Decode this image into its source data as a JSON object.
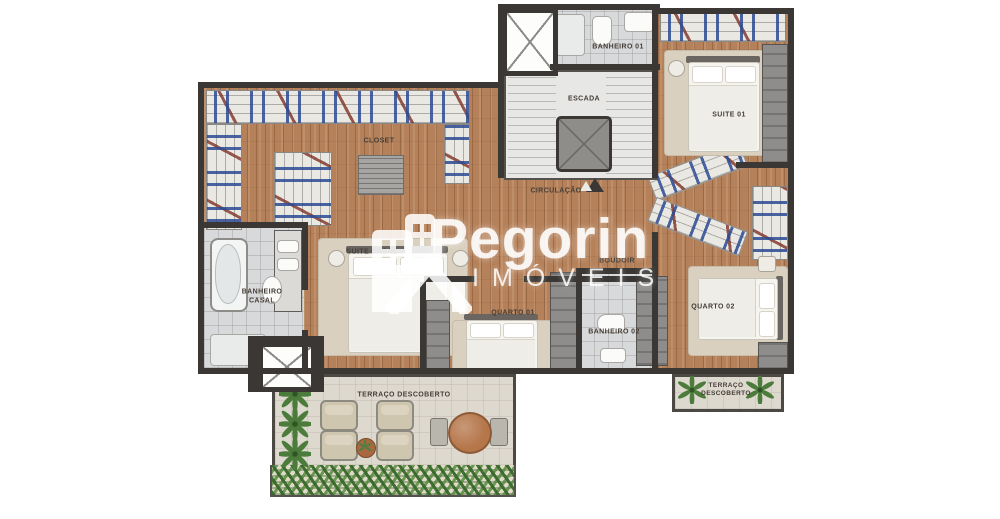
{
  "watermark": {
    "brand": "Pegorin",
    "subtitle": "IMÓVEIS"
  },
  "plan": {
    "type": "floor-plan",
    "labels": {
      "banheiro01": "BANHEIRO 01",
      "escada": "ESCADA",
      "suite01": "SUITE 01",
      "circulacao": "CIRCULAÇÃO",
      "closet": "CLOSET",
      "banheiro_casal": "BANHEIRO CASAL",
      "suite_casal": "SUITE CASAL",
      "quarto01": "QUARTO 01",
      "boudoir": "BOUDOIR",
      "banheiro02": "BANHEIRO 02",
      "quarto02": "QUARTO 02",
      "terraco_descoberto": "TERRAÇO DESCOBERTO",
      "terraco_descoberto_2": "TERRAÇO DESCOBERTO"
    },
    "colors": {
      "wood_floor": "#b5815a",
      "walls": "#3a3734",
      "bathroom_tile": "#d8d9da",
      "terrace_floor": "#ded9cf",
      "rug": "#d9d0bf",
      "closet_blue": "#2b4a94",
      "closet_red": "#7e3224",
      "greenery": "#38682c",
      "watermark_white": "#ffffff"
    }
  }
}
